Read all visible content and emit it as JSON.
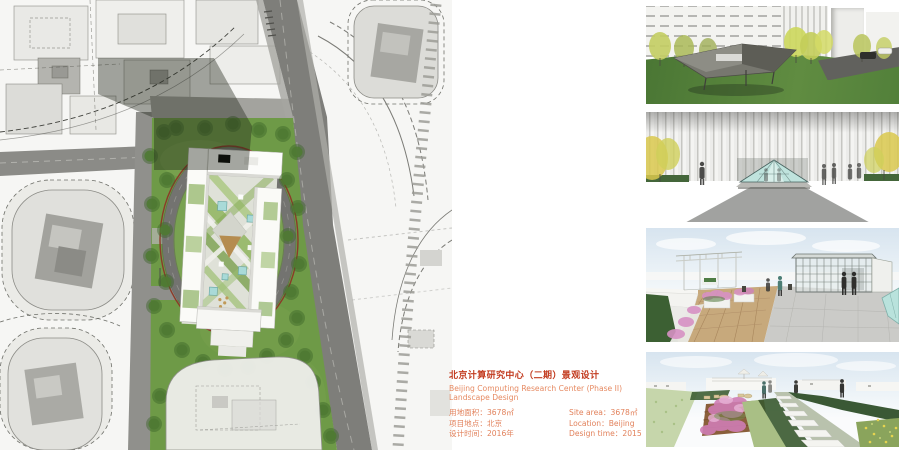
{
  "info": {
    "title_cn": "北京计算研究中心（二期）景观设计",
    "title_en": "Beijing Computing Research Center (Phase II) Landscape Design",
    "title_color": "#c23a1e",
    "body_color": "#e2825c",
    "details_cn": [
      {
        "label": "用地面积：",
        "value": "3678㎡"
      },
      {
        "label": "项目地点：",
        "value": "北京"
      },
      {
        "label": "设计时间：",
        "value": "2016年"
      }
    ],
    "details_en": [
      {
        "label": "Site area：",
        "value": "3678㎡"
      },
      {
        "label": "Location：",
        "value": "Beijing"
      },
      {
        "label": "Design time：",
        "value": "2015"
      }
    ]
  },
  "site_plan": {
    "alt": "Site masterplan with oval ring road, central research building and green landscape"
  },
  "renders": [
    {
      "alt": "Entry lawn with sculptural signage canopy in front of research building"
    },
    {
      "alt": "Entrance plaza with glass pyramid skylight against ribbed facade"
    },
    {
      "alt": "Roof terrace with white pergola, timber deck and glass pavilion"
    },
    {
      "alt": "Roof garden with flower beds and stepping stone path"
    }
  ]
}
